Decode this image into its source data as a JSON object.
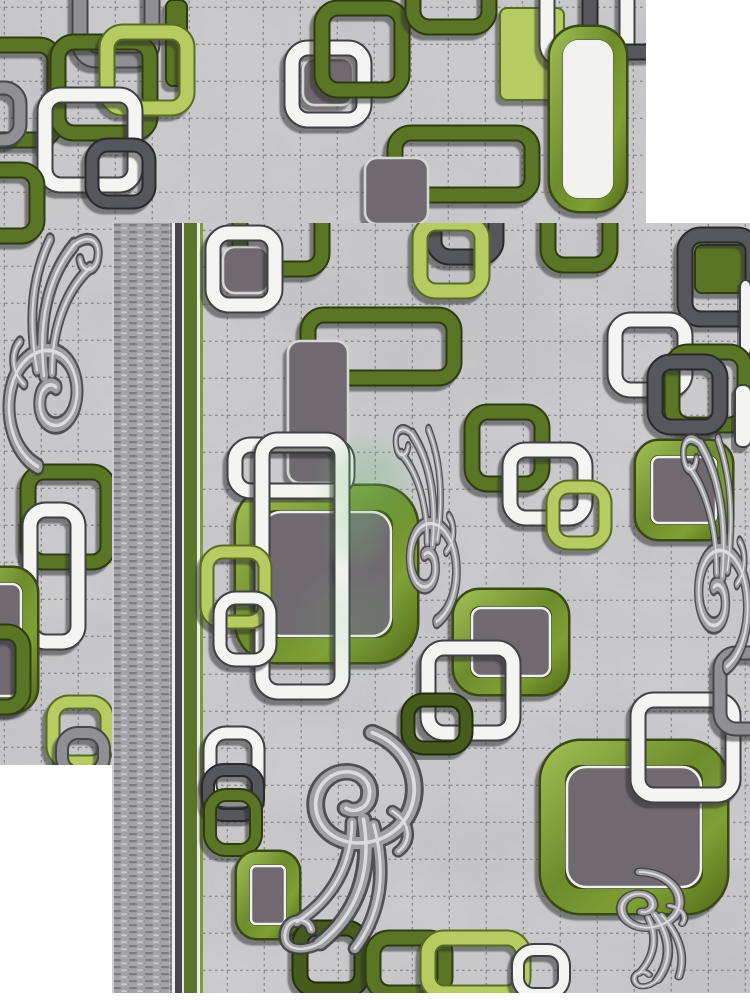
{
  "alt": "Two overlapping photos of a gray modern rug with green, white and gray chain-square pattern and gray baroque flourishes",
  "page": {
    "width": 750,
    "height": 1000,
    "background": "#ffffff"
  },
  "palette": {
    "marble_base": "#cdcdcf",
    "grid_line": "#5d5d64",
    "watermark_green": "#6fbe73",
    "speckle_greens": [
      "#9ab84f",
      "#6d8c2d",
      "#7fa034",
      "#5d771f"
    ],
    "chains": {
      "white": {
        "main": "#f4f4f2",
        "edge": "#3f3f44"
      },
      "olive": {
        "main": "#5a7527",
        "edge": "#2e3c11"
      },
      "darkOlive": {
        "main": "#465c1f",
        "edge": "#222e0d"
      },
      "lime": {
        "main": "#b6cc63",
        "edge": "#5a6c22"
      },
      "grayDark": {
        "main": "#57575d",
        "edge": "#2a2a2f"
      },
      "grayMid": {
        "main": "#8f8f94",
        "edge": "#47474c"
      },
      "fillGray": {
        "main": "#6f6a70",
        "edge": "#d6d6d4"
      }
    },
    "selvage": {
      "base": "#a4a4a8",
      "dark": "#7c7c82",
      "light": "#c7c7cb"
    }
  },
  "grid": {
    "cell": 37,
    "opacity": 0.55
  },
  "carpets": [
    {
      "name": "carpet-top-left",
      "x": 0,
      "y": 0,
      "width": 646,
      "height": 765,
      "shapes": [
        {
          "kind": "chain",
          "color": "grayMid",
          "x": 80,
          "y": -28,
          "w": 72,
          "h": 88
        },
        {
          "kind": "bar",
          "color": "olive",
          "x": 166,
          "y": 0,
          "w": 21,
          "h": 86
        },
        {
          "kind": "chain",
          "color": "olive",
          "x": -55,
          "y": 45,
          "w": 110,
          "h": 95
        },
        {
          "kind": "chain",
          "color": "olive",
          "x": 58,
          "y": 42,
          "w": 92,
          "h": 91
        },
        {
          "kind": "chain",
          "color": "lime",
          "x": 107,
          "y": 32,
          "w": 80,
          "h": 76
        },
        {
          "kind": "chain",
          "color": "white",
          "x": 45,
          "y": 95,
          "w": 90,
          "h": 90
        },
        {
          "kind": "chain",
          "color": "grayDark",
          "x": 92,
          "y": 145,
          "w": 57,
          "h": 57,
          "sw": 11
        },
        {
          "kind": "chain",
          "color": "grayMid",
          "x": -30,
          "y": 88,
          "w": 50,
          "h": 52,
          "sw": 11
        },
        {
          "kind": "chain",
          "color": "olive",
          "x": -35,
          "y": 170,
          "w": 72,
          "h": 66
        },
        {
          "kind": "fill",
          "color": "fillGray",
          "x": 303,
          "y": 58,
          "w": 50,
          "h": 47
        },
        {
          "kind": "chain",
          "color": "white",
          "x": 292,
          "y": 48,
          "w": 72,
          "h": 72
        },
        {
          "kind": "chain",
          "color": "olive",
          "x": 322,
          "y": 8,
          "w": 80,
          "h": 82
        },
        {
          "kind": "chain",
          "color": "olive",
          "x": 413,
          "y": -48,
          "w": 76,
          "h": 75
        },
        {
          "kind": "bar",
          "color": "lime",
          "x": 500,
          "y": 8,
          "w": 64,
          "h": 92
        },
        {
          "kind": "chain",
          "color": "white",
          "x": 547,
          "y": -32,
          "w": 80,
          "h": 92
        },
        {
          "kind": "chain",
          "color": "grayDark",
          "x": 590,
          "y": -25,
          "w": 70,
          "h": 77
        },
        {
          "kind": "chain",
          "color": "olive",
          "x": 395,
          "y": 133,
          "w": 137,
          "h": 62
        },
        {
          "kind": "fill",
          "color": "fillGray",
          "x": 365,
          "y": 158,
          "w": 63,
          "h": 66
        },
        {
          "kind": "speck",
          "fill": "#f2f2ef",
          "x": 556,
          "y": 33,
          "w": 64,
          "h": 172,
          "sw": 12,
          "r": 24
        },
        {
          "kind": "chain",
          "color": "olive",
          "x": 28,
          "y": 472,
          "w": 80,
          "h": 90
        },
        {
          "kind": "chain",
          "color": "white",
          "x": 30,
          "y": 510,
          "w": 48,
          "h": 132
        },
        {
          "kind": "speck",
          "fill": "#6f6a70",
          "x": -28,
          "y": 575,
          "w": 58,
          "h": 130,
          "sw": 14,
          "r": 18
        },
        {
          "kind": "chain",
          "color": "olive",
          "x": -45,
          "y": 632,
          "w": 68,
          "h": 75
        },
        {
          "kind": "chain",
          "color": "lime",
          "x": 53,
          "y": 702,
          "w": 54,
          "h": 60,
          "sw": 11
        },
        {
          "kind": "chain",
          "color": "grayMid",
          "x": 62,
          "y": 733,
          "w": 42,
          "h": 40,
          "sw": 10
        }
      ],
      "ornaments": [
        {
          "x": 4,
          "y": 228,
          "sx": 1.0,
          "sy": 1.42,
          "rot": 0,
          "flip": false
        }
      ],
      "watermark": {
        "blobs": []
      }
    },
    {
      "name": "carpet-bottom-right",
      "x": 112,
      "y": 223,
      "width": 638,
      "height": 770,
      "selvage": {
        "width": 60
      },
      "stripes": [
        {
          "x": 60,
          "w": 3,
          "color": "#ececea"
        },
        {
          "x": 63,
          "w": 7,
          "color": "#46464c"
        },
        {
          "x": 70,
          "w": 2,
          "color": "#e5e5e3"
        },
        {
          "x": 72,
          "w": 13,
          "color": "#5a7527"
        },
        {
          "x": 85,
          "w": 3,
          "color": "#ececea"
        },
        {
          "x": 88,
          "w": 3,
          "color": "#7e9a39"
        }
      ],
      "shapes": [
        {
          "kind": "chain",
          "color": "olive",
          "x": 128,
          "y": -18,
          "w": 82,
          "h": 64
        },
        {
          "kind": "chain",
          "color": "grayDark",
          "x": 322,
          "y": -30,
          "w": 62,
          "h": 64
        },
        {
          "kind": "chain",
          "color": "olive",
          "x": 436,
          "y": -28,
          "w": 62,
          "h": 70
        },
        {
          "kind": "fill",
          "color": "fillGray",
          "x": 111,
          "y": 24,
          "w": 46,
          "h": 46
        },
        {
          "kind": "chain",
          "color": "white",
          "x": 101,
          "y": 10,
          "w": 62,
          "h": 72
        },
        {
          "kind": "chain",
          "color": "lime",
          "x": 308,
          "y": 0,
          "w": 62,
          "h": 68
        },
        {
          "kind": "bar",
          "color": "olive",
          "x": 583,
          "y": 22,
          "w": 52,
          "h": 48
        },
        {
          "kind": "chain",
          "color": "grayDark",
          "x": 573,
          "y": 12,
          "w": 68,
          "h": 84
        },
        {
          "kind": "bar",
          "color": "white",
          "x": 628,
          "y": 57,
          "w": 11,
          "h": 76
        },
        {
          "kind": "chain",
          "color": "olive",
          "x": 196,
          "y": 92,
          "w": 146,
          "h": 63
        },
        {
          "kind": "fill",
          "color": "fillGray",
          "x": 176,
          "y": 118,
          "w": 60,
          "h": 142
        },
        {
          "kind": "chain",
          "color": "white",
          "x": 503,
          "y": 97,
          "w": 70,
          "h": 70
        },
        {
          "kind": "chain",
          "color": "olive",
          "x": 560,
          "y": 129,
          "w": 73,
          "h": 73
        },
        {
          "kind": "chain",
          "color": "grayDark",
          "x": 543,
          "y": 139,
          "w": 65,
          "h": 65
        },
        {
          "kind": "bar",
          "color": "white",
          "x": 623,
          "y": 162,
          "w": 16,
          "h": 62
        },
        {
          "kind": "speck",
          "fill": "#6f6a70",
          "x": 531,
          "y": 225,
          "w": 82,
          "h": 84,
          "sw": 14,
          "r": 16
        },
        {
          "kind": "chain",
          "color": "olive",
          "x": 360,
          "y": 189,
          "w": 70,
          "h": 72
        },
        {
          "kind": "chain",
          "color": "white",
          "x": 398,
          "y": 227,
          "w": 75,
          "h": 68
        },
        {
          "kind": "chain",
          "color": "lime",
          "x": 441,
          "y": 264,
          "w": 52,
          "h": 56,
          "sw": 11
        },
        {
          "kind": "speck",
          "fill": "#6f6a70",
          "x": 136,
          "y": 275,
          "w": 157,
          "h": 152,
          "sw": 24,
          "r": 28
        },
        {
          "kind": "chain",
          "color": "white",
          "x": 123,
          "y": 222,
          "w": 112,
          "h": 46
        },
        {
          "kind": "chain",
          "color": "white",
          "x": 150,
          "y": 217,
          "w": 80,
          "h": 252
        },
        {
          "kind": "chain",
          "color": "lime",
          "x": 95,
          "y": 329,
          "w": 58,
          "h": 70,
          "sw": 11
        },
        {
          "kind": "chain",
          "color": "white",
          "x": 108,
          "y": 375,
          "w": 50,
          "h": 62,
          "sw": 11
        },
        {
          "kind": "speck",
          "fill": "#6f6a70",
          "x": 350,
          "y": 375,
          "w": 98,
          "h": 88,
          "sw": 16,
          "r": 18
        },
        {
          "kind": "chain",
          "color": "white",
          "x": 316,
          "y": 425,
          "w": 85,
          "h": 85
        },
        {
          "kind": "chain",
          "color": "darkOlive",
          "x": 296,
          "y": 477,
          "w": 58,
          "h": 48,
          "sw": 11
        },
        {
          "kind": "chain",
          "color": "white",
          "x": 98,
          "y": 510,
          "w": 48,
          "h": 68,
          "sw": 11
        },
        {
          "kind": "chain",
          "color": "grayDark",
          "x": 96,
          "y": 547,
          "w": 50,
          "h": 45,
          "sw": 10
        },
        {
          "kind": "chain",
          "color": "olive",
          "x": 98,
          "y": 572,
          "w": 46,
          "h": 55,
          "sw": 10
        },
        {
          "kind": "speck",
          "fill": "#6f6a70",
          "x": 131,
          "y": 635,
          "w": 50,
          "h": 74,
          "sw": 12,
          "r": 14
        },
        {
          "kind": "speck",
          "fill": "#6f6a70",
          "x": 441,
          "y": 530,
          "w": 162,
          "h": 148,
          "sw": 24,
          "r": 28
        },
        {
          "kind": "chain",
          "color": "white",
          "x": 526,
          "y": 477,
          "w": 95,
          "h": 95
        },
        {
          "kind": "chain",
          "color": "grayMid",
          "x": 608,
          "y": 430,
          "w": 46,
          "h": 76,
          "sw": 11
        },
        {
          "kind": "chain",
          "color": "darkOlive",
          "x": 188,
          "y": 705,
          "w": 62,
          "h": 62
        },
        {
          "kind": "chain",
          "color": "olive",
          "x": 261,
          "y": 715,
          "w": 72,
          "h": 55
        },
        {
          "kind": "chain",
          "color": "lime",
          "x": 316,
          "y": 715,
          "w": 95,
          "h": 55
        },
        {
          "kind": "chain",
          "color": "white",
          "x": 406,
          "y": 727,
          "w": 46,
          "h": 44,
          "sw": 10
        }
      ],
      "ornaments": [
        {
          "x": 273,
          "y": 197,
          "sx": 0.68,
          "sy": 1.2,
          "rot": 0,
          "flip": true
        },
        {
          "x": 150,
          "y": 507,
          "sx": 1.45,
          "sy": 1.35,
          "rot": 180,
          "flip": false
        },
        {
          "x": 560,
          "y": 205,
          "sx": 0.72,
          "sy": 1.42,
          "rot": 0,
          "flip": true
        },
        {
          "x": 486,
          "y": 649,
          "sx": 0.9,
          "sy": 0.68,
          "rot": 160,
          "flip": false
        }
      ],
      "watermark": {
        "blobs": [
          {
            "cx": 256,
            "cy": 262,
            "r": 55,
            "o": 0.42
          },
          {
            "cx": 242,
            "cy": 315,
            "r": 34,
            "o": 0.3
          },
          {
            "cx": 240,
            "cy": 400,
            "r": 60,
            "o": 0.18
          }
        ]
      }
    }
  ]
}
